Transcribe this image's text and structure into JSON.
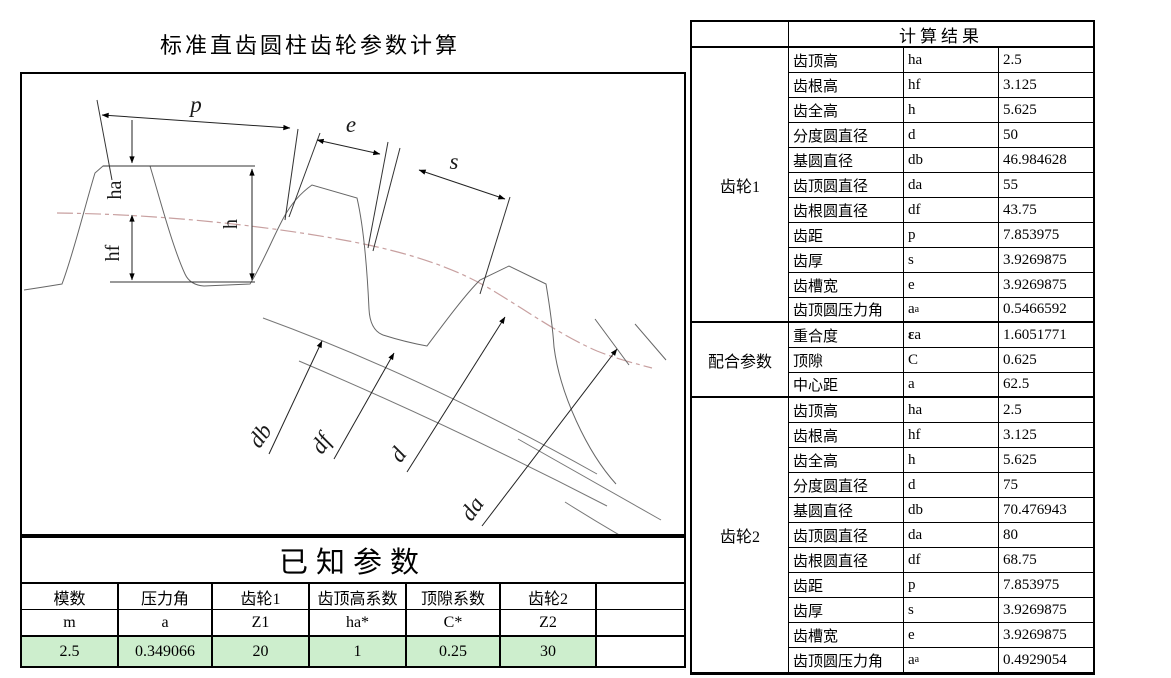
{
  "page": {
    "title": "标准直齿圆柱齿轮参数计算"
  },
  "colors": {
    "highlight_green": "#cdeecd",
    "pitch_line_pink": "#c8a0a0",
    "line_dark": "#2a2a2a",
    "tooth_line": "#666666"
  },
  "results_table": {
    "header": "计算结果",
    "sections": [
      {
        "label": "齿轮1",
        "rows": [
          {
            "name": "齿顶高",
            "symbol": "ha",
            "value": "2.5"
          },
          {
            "name": "齿根高",
            "symbol": "hf",
            "value": "3.125"
          },
          {
            "name": "齿全高",
            "symbol": "h",
            "value": "5.625"
          },
          {
            "name": "分度圆直径",
            "symbol": "d",
            "value": "50"
          },
          {
            "name": "基圆直径",
            "symbol": "db",
            "value": "46.984628"
          },
          {
            "name": "齿顶圆直径",
            "symbol": "da",
            "value": "55"
          },
          {
            "name": "齿根圆直径",
            "symbol": "df",
            "value": "43.75"
          },
          {
            "name": "齿距",
            "symbol": "p",
            "value": "7.853975"
          },
          {
            "name": "齿厚",
            "symbol": "s",
            "value": "3.9269875"
          },
          {
            "name": "齿槽宽",
            "symbol": "e",
            "value": "3.9269875"
          },
          {
            "name": "齿顶圆压力角",
            "symbol": "a_a",
            "value": "0.5466592"
          }
        ]
      },
      {
        "label": "配合参数",
        "rows": [
          {
            "name": "重合度",
            "symbol": "ε a",
            "value": "1.6051771"
          },
          {
            "name": "顶隙",
            "symbol": "C",
            "value": "0.625"
          },
          {
            "name": "中心距",
            "symbol": "a",
            "value": "62.5"
          }
        ]
      },
      {
        "label": "齿轮2",
        "rows": [
          {
            "name": "齿顶高",
            "symbol": "ha",
            "value": "2.5"
          },
          {
            "name": "齿根高",
            "symbol": "hf",
            "value": "3.125"
          },
          {
            "name": "齿全高",
            "symbol": "h",
            "value": "5.625"
          },
          {
            "name": "分度圆直径",
            "symbol": "d",
            "value": "75"
          },
          {
            "name": "基圆直径",
            "symbol": "db",
            "value": "70.476943"
          },
          {
            "name": "齿顶圆直径",
            "symbol": "da",
            "value": "80"
          },
          {
            "name": "齿根圆直径",
            "symbol": "df",
            "value": "68.75"
          },
          {
            "name": "齿距",
            "symbol": "p",
            "value": "7.853975"
          },
          {
            "name": "齿厚",
            "symbol": "s",
            "value": "3.9269875"
          },
          {
            "name": "齿槽宽",
            "symbol": "e",
            "value": "3.9269875"
          },
          {
            "name": "齿顶圆压力角",
            "symbol": "a_a",
            "value": "0.4929054"
          }
        ]
      }
    ]
  },
  "known_table": {
    "title": "已知参数",
    "columns": [
      {
        "name": "模数",
        "symbol": "m",
        "value": "2.5"
      },
      {
        "name": "压力角",
        "symbol": "a",
        "value": "0.349066"
      },
      {
        "name": "齿轮1",
        "symbol": "Z1",
        "value": "20"
      },
      {
        "name": "齿顶高系数",
        "symbol": "ha*",
        "value": "1"
      },
      {
        "name": "顶隙系数",
        "symbol": "C*",
        "value": "0.25"
      },
      {
        "name": "齿轮2",
        "symbol": "Z2",
        "value": "30"
      },
      {
        "name": "",
        "symbol": "",
        "value": ""
      }
    ]
  },
  "diagram": {
    "labels": {
      "p": "p",
      "e": "e",
      "s": "s",
      "ha": "ha",
      "hf": "hf",
      "h": "h",
      "db": "db",
      "df": "df",
      "d": "d",
      "da": "da"
    }
  }
}
